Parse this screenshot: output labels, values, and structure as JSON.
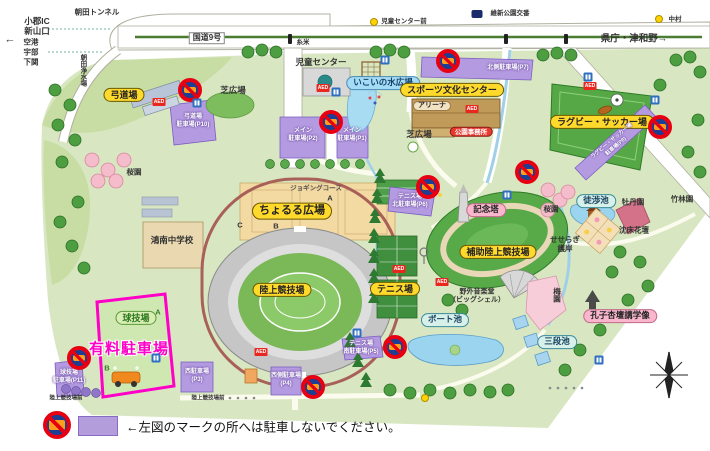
{
  "colors": {
    "no_parking_red": "#e60012",
    "parking_purple": "#b39ddb",
    "paid_magenta": "#ff00c8",
    "label_yellow": "#ffd92b"
  },
  "top": {
    "ogori": "小郡IC",
    "shinyamaguchi": "新山口",
    "kuko": "空港",
    "ube": "宇部",
    "shimonoseki": "下関",
    "west_arrow": "←",
    "asada_tunnel": "朝田トンネル",
    "route9": "国道9号",
    "asada_water": "朝田浄水場",
    "itoyone": "糸米",
    "jido_center_mae": "児童センター前",
    "ishin_koban": "維新公園交番",
    "nakamura": "中村",
    "kencho_tsuwano": "県庁・津和野→"
  },
  "facility": {
    "kyudojo": "弓道場",
    "jido_center": "児童センター",
    "shibahiroba_nw": "芝広場",
    "shibahiroba_c": "芝広場",
    "ikoi_mizu": "いこいの水広場",
    "sports_center": "スポーツ文化センター",
    "arena": "アリーナ",
    "park_office": "公園事務所",
    "rugby_soccer": "ラグビー・サッカー場",
    "choruru": "ちょるる広場",
    "jogging_course": "ジョギングコース",
    "rikujo": "陸上競技場",
    "hojo_rikujo": "補助陸上競技場",
    "kinento": "記念塔",
    "tennis": "テニス場",
    "yagai_ongakudo": "野外音楽堂\n（ビッグシェル）",
    "boat_pond": "ボート池",
    "sandan_pond": "三段池",
    "tosho_pond": "徒渉池",
    "koshi_statue": "孔子杏壇講学像",
    "botan_garden": "牡丹園",
    "chinsho_kadan": "沈床花壇",
    "seseragi": "せせらぎ\n護岸",
    "sakura_w": "桜園",
    "sakura_e": "桜園",
    "ume_garden": "梅園",
    "chikurin": "竹林園",
    "kyugijo": "球技場",
    "konan_school": "鴻南中学校",
    "yuryo_parking": "有料駐車場",
    "rikujo_mae_stop": "陸上競技場前",
    "marker_a": "A",
    "marker_b": "B",
    "marker_c": "C"
  },
  "parking": {
    "kyudo": "弓道場\n駐車場(P10)",
    "main_p2": "メイン\n駐車場(P2)",
    "main_p1": "メイン\n駐車場(P1)",
    "north_p7": "北側駐車場(P7)",
    "tennis_n_p6": "テニス場\n北駐車場(P6)",
    "tennis_s_p5": "テニス場\n南駐車場(P5)",
    "west_side_p4": "西側駐車場\n(P4)",
    "west_p3": "西駐車場\n(P3)",
    "kyugijo_p11": "球技場\n駐車場(P11)",
    "rugby_p8": "ラグビー・サッカー場\n駐車場(P8)"
  },
  "icons": {
    "aed": "AED"
  },
  "legend": {
    "note": "←左図のマークの所へは駐車しないでください。"
  }
}
